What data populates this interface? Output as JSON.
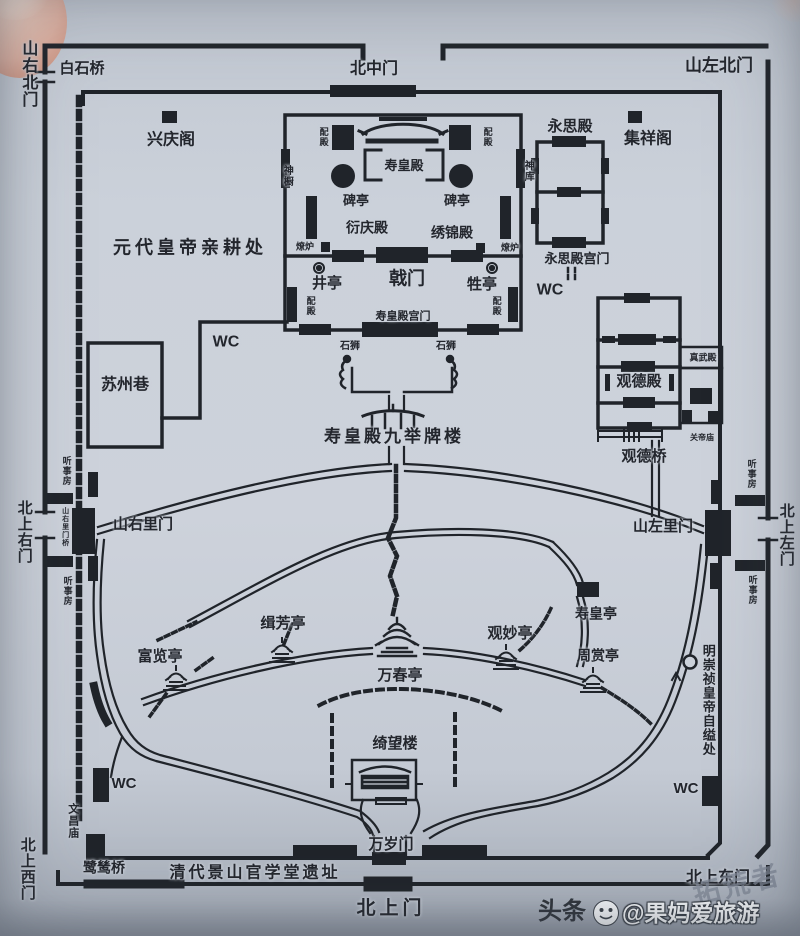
{
  "palette": {
    "paper": "#cbd1da",
    "ink": "#20242a",
    "finger": "#e2b4a4",
    "watermark_gray": "#7d8694",
    "watermark_white": "#f3f5f7"
  },
  "watermark": {
    "brand": "头条",
    "account": "@果妈爱旅游",
    "ghost": "拓荒者",
    "icon": "wechat-face-icon"
  },
  "labels": [
    {
      "id": "shanyou-north-gate",
      "text": "山右北门",
      "x": 27,
      "y": 74,
      "size": 16,
      "v": true
    },
    {
      "id": "baishi-bridge",
      "text": "白石桥",
      "x": 82,
      "y": 69,
      "size": 15
    },
    {
      "id": "beizhong-gate",
      "text": "北中门",
      "x": 374,
      "y": 70,
      "size": 16
    },
    {
      "id": "shanzuo-north-gate",
      "text": "山左北门",
      "x": 719,
      "y": 66,
      "size": 17
    },
    {
      "id": "xingqing-pavilion",
      "text": "兴庆阁",
      "x": 171,
      "y": 141,
      "size": 16
    },
    {
      "id": "jixiang-pavilion",
      "text": "集祥阁",
      "x": 648,
      "y": 140,
      "size": 16
    },
    {
      "id": "yuandai-qingeng",
      "text": "元代皇帝亲耕处",
      "x": 190,
      "y": 248,
      "size": 18,
      "ls": 4
    },
    {
      "id": "yongsi-hall",
      "text": "永思殿",
      "x": 570,
      "y": 127,
      "size": 15
    },
    {
      "id": "peidian-tl",
      "text": "配殿",
      "x": 323,
      "y": 137,
      "size": 9,
      "v": true
    },
    {
      "id": "peidian-tr",
      "text": "配殿",
      "x": 487,
      "y": 137,
      "size": 9,
      "v": true
    },
    {
      "id": "peidian-bl",
      "text": "配殿",
      "x": 310,
      "y": 306,
      "size": 9,
      "v": true
    },
    {
      "id": "peidian-br",
      "text": "配殿",
      "x": 496,
      "y": 306,
      "size": 9,
      "v": true
    },
    {
      "id": "shenchu",
      "text": "神橱",
      "x": 286,
      "y": 176,
      "size": 10,
      "v": true
    },
    {
      "id": "shenku",
      "text": "神库",
      "x": 527,
      "y": 171,
      "size": 10,
      "v": true
    },
    {
      "id": "shouhuang-hall",
      "text": "寿皇殿",
      "x": 404,
      "y": 166,
      "size": 13
    },
    {
      "id": "beiting-left",
      "text": "碑亭",
      "x": 356,
      "y": 201,
      "size": 13
    },
    {
      "id": "beiting-right",
      "text": "碑亭",
      "x": 457,
      "y": 201,
      "size": 13
    },
    {
      "id": "yanqing-hall",
      "text": "衍庆殿",
      "x": 367,
      "y": 228,
      "size": 14
    },
    {
      "id": "xiujin-hall",
      "text": "绣锦殿",
      "x": 452,
      "y": 233,
      "size": 14
    },
    {
      "id": "liaolu-left",
      "text": "燎炉",
      "x": 305,
      "y": 247,
      "size": 9
    },
    {
      "id": "liaolu-right",
      "text": "燎炉",
      "x": 510,
      "y": 248,
      "size": 9
    },
    {
      "id": "ji-gate",
      "text": "戟门",
      "x": 407,
      "y": 279,
      "size": 18
    },
    {
      "id": "jing-pavilion",
      "text": "井亭",
      "x": 327,
      "y": 284,
      "size": 15
    },
    {
      "id": "sheng-pavilion",
      "text": "牲亭",
      "x": 482,
      "y": 285,
      "size": 15
    },
    {
      "id": "shouhuang-gongmen",
      "text": "寿皇殿宫门",
      "x": 403,
      "y": 317,
      "size": 11
    },
    {
      "id": "shishi-left",
      "text": "石狮",
      "x": 350,
      "y": 347,
      "size": 10
    },
    {
      "id": "shishi-right",
      "text": "石狮",
      "x": 446,
      "y": 347,
      "size": 10
    },
    {
      "id": "wc-suzhou",
      "text": "WC",
      "x": 226,
      "y": 343,
      "size": 16
    },
    {
      "id": "suzhou-lane",
      "text": "苏州巷",
      "x": 125,
      "y": 386,
      "size": 16
    },
    {
      "id": "yongsi-gongmen",
      "text": "永思殿宫门",
      "x": 577,
      "y": 259,
      "size": 13
    },
    {
      "id": "wc-yongsi",
      "text": "WC",
      "x": 550,
      "y": 291,
      "size": 16
    },
    {
      "id": "guande-hall",
      "text": "观德殿",
      "x": 639,
      "y": 382,
      "size": 15
    },
    {
      "id": "zhenwu-hall",
      "text": "真武殿",
      "x": 703,
      "y": 358,
      "size": 9
    },
    {
      "id": "guandi-temple",
      "text": "关帝庙",
      "x": 702,
      "y": 438,
      "size": 8
    },
    {
      "id": "guande-bridge",
      "text": "观德桥",
      "x": 644,
      "y": 457,
      "size": 15
    },
    {
      "id": "pailou",
      "text": "寿皇殿九举牌楼",
      "x": 394,
      "y": 437,
      "size": 17,
      "ls": 3
    },
    {
      "id": "tingshifang-left-top",
      "text": "听事房",
      "x": 66,
      "y": 471,
      "size": 9,
      "v": true
    },
    {
      "id": "tingshifang-left-bottom",
      "text": "听事房",
      "x": 67,
      "y": 591,
      "size": 9,
      "v": true
    },
    {
      "id": "tingshifang-right-top",
      "text": "听事房",
      "x": 751,
      "y": 474,
      "size": 9,
      "v": true
    },
    {
      "id": "tingshifang-right-bottom",
      "text": "听事房",
      "x": 752,
      "y": 590,
      "size": 9,
      "v": true
    },
    {
      "id": "shanyouli-bridge",
      "text": "山右里门桥",
      "x": 65,
      "y": 527,
      "size": 7,
      "v": true
    },
    {
      "id": "beishang-right-gate",
      "text": "北上右门",
      "x": 24,
      "y": 532,
      "size": 15,
      "v": true
    },
    {
      "id": "shanyouli-gate",
      "text": "山右里门",
      "x": 143,
      "y": 525,
      "size": 15
    },
    {
      "id": "shanzuoli-gate",
      "text": "山左里门",
      "x": 663,
      "y": 527,
      "size": 15
    },
    {
      "id": "beishang-left-gate",
      "text": "北上左门",
      "x": 786,
      "y": 535,
      "size": 15,
      "v": true
    },
    {
      "id": "chongzhen-suicide-site",
      "text": "明崇祯皇帝自缢处",
      "x": 708,
      "y": 700,
      "size": 13,
      "v": true
    },
    {
      "id": "fulan-pavilion",
      "text": "富览亭",
      "x": 160,
      "y": 657,
      "size": 15
    },
    {
      "id": "jifang-pavilion",
      "text": "缉芳亭",
      "x": 283,
      "y": 624,
      "size": 15
    },
    {
      "id": "wanchun-pavilion",
      "text": "万春亭",
      "x": 400,
      "y": 676,
      "size": 15
    },
    {
      "id": "guanmiao-pavilion",
      "text": "观妙亭",
      "x": 510,
      "y": 634,
      "size": 15
    },
    {
      "id": "shouhuang-pavilion",
      "text": "寿皇亭",
      "x": 596,
      "y": 614,
      "size": 14
    },
    {
      "id": "zhoushang-pavilion",
      "text": "周赏亭",
      "x": 598,
      "y": 656,
      "size": 14
    },
    {
      "id": "qiwang-tower",
      "text": "绮望楼",
      "x": 395,
      "y": 744,
      "size": 15
    },
    {
      "id": "wc-southwest",
      "text": "WC",
      "x": 124,
      "y": 784,
      "size": 15
    },
    {
      "id": "wenchang-temple",
      "text": "文昌庙",
      "x": 72,
      "y": 821,
      "size": 11,
      "v": true
    },
    {
      "id": "wc-southeast",
      "text": "WC",
      "x": 686,
      "y": 789,
      "size": 15
    },
    {
      "id": "lusi-bridge",
      "text": "鹭鸶桥",
      "x": 104,
      "y": 868,
      "size": 14
    },
    {
      "id": "qingdai-school-site",
      "text": "清代景山官学堂遗址",
      "x": 255,
      "y": 874,
      "size": 16,
      "ls": 3
    },
    {
      "id": "wansui-gate",
      "text": "万岁门",
      "x": 391,
      "y": 845,
      "size": 15
    },
    {
      "id": "beishang-gate",
      "text": "北上门",
      "x": 391,
      "y": 909,
      "size": 19,
      "ls": 4
    },
    {
      "id": "beishang-east-gate",
      "text": "北上东门",
      "x": 718,
      "y": 879,
      "size": 16
    },
    {
      "id": "beishang-west-gate",
      "text": "北上西门",
      "x": 27,
      "y": 869,
      "size": 15,
      "v": true
    }
  ]
}
